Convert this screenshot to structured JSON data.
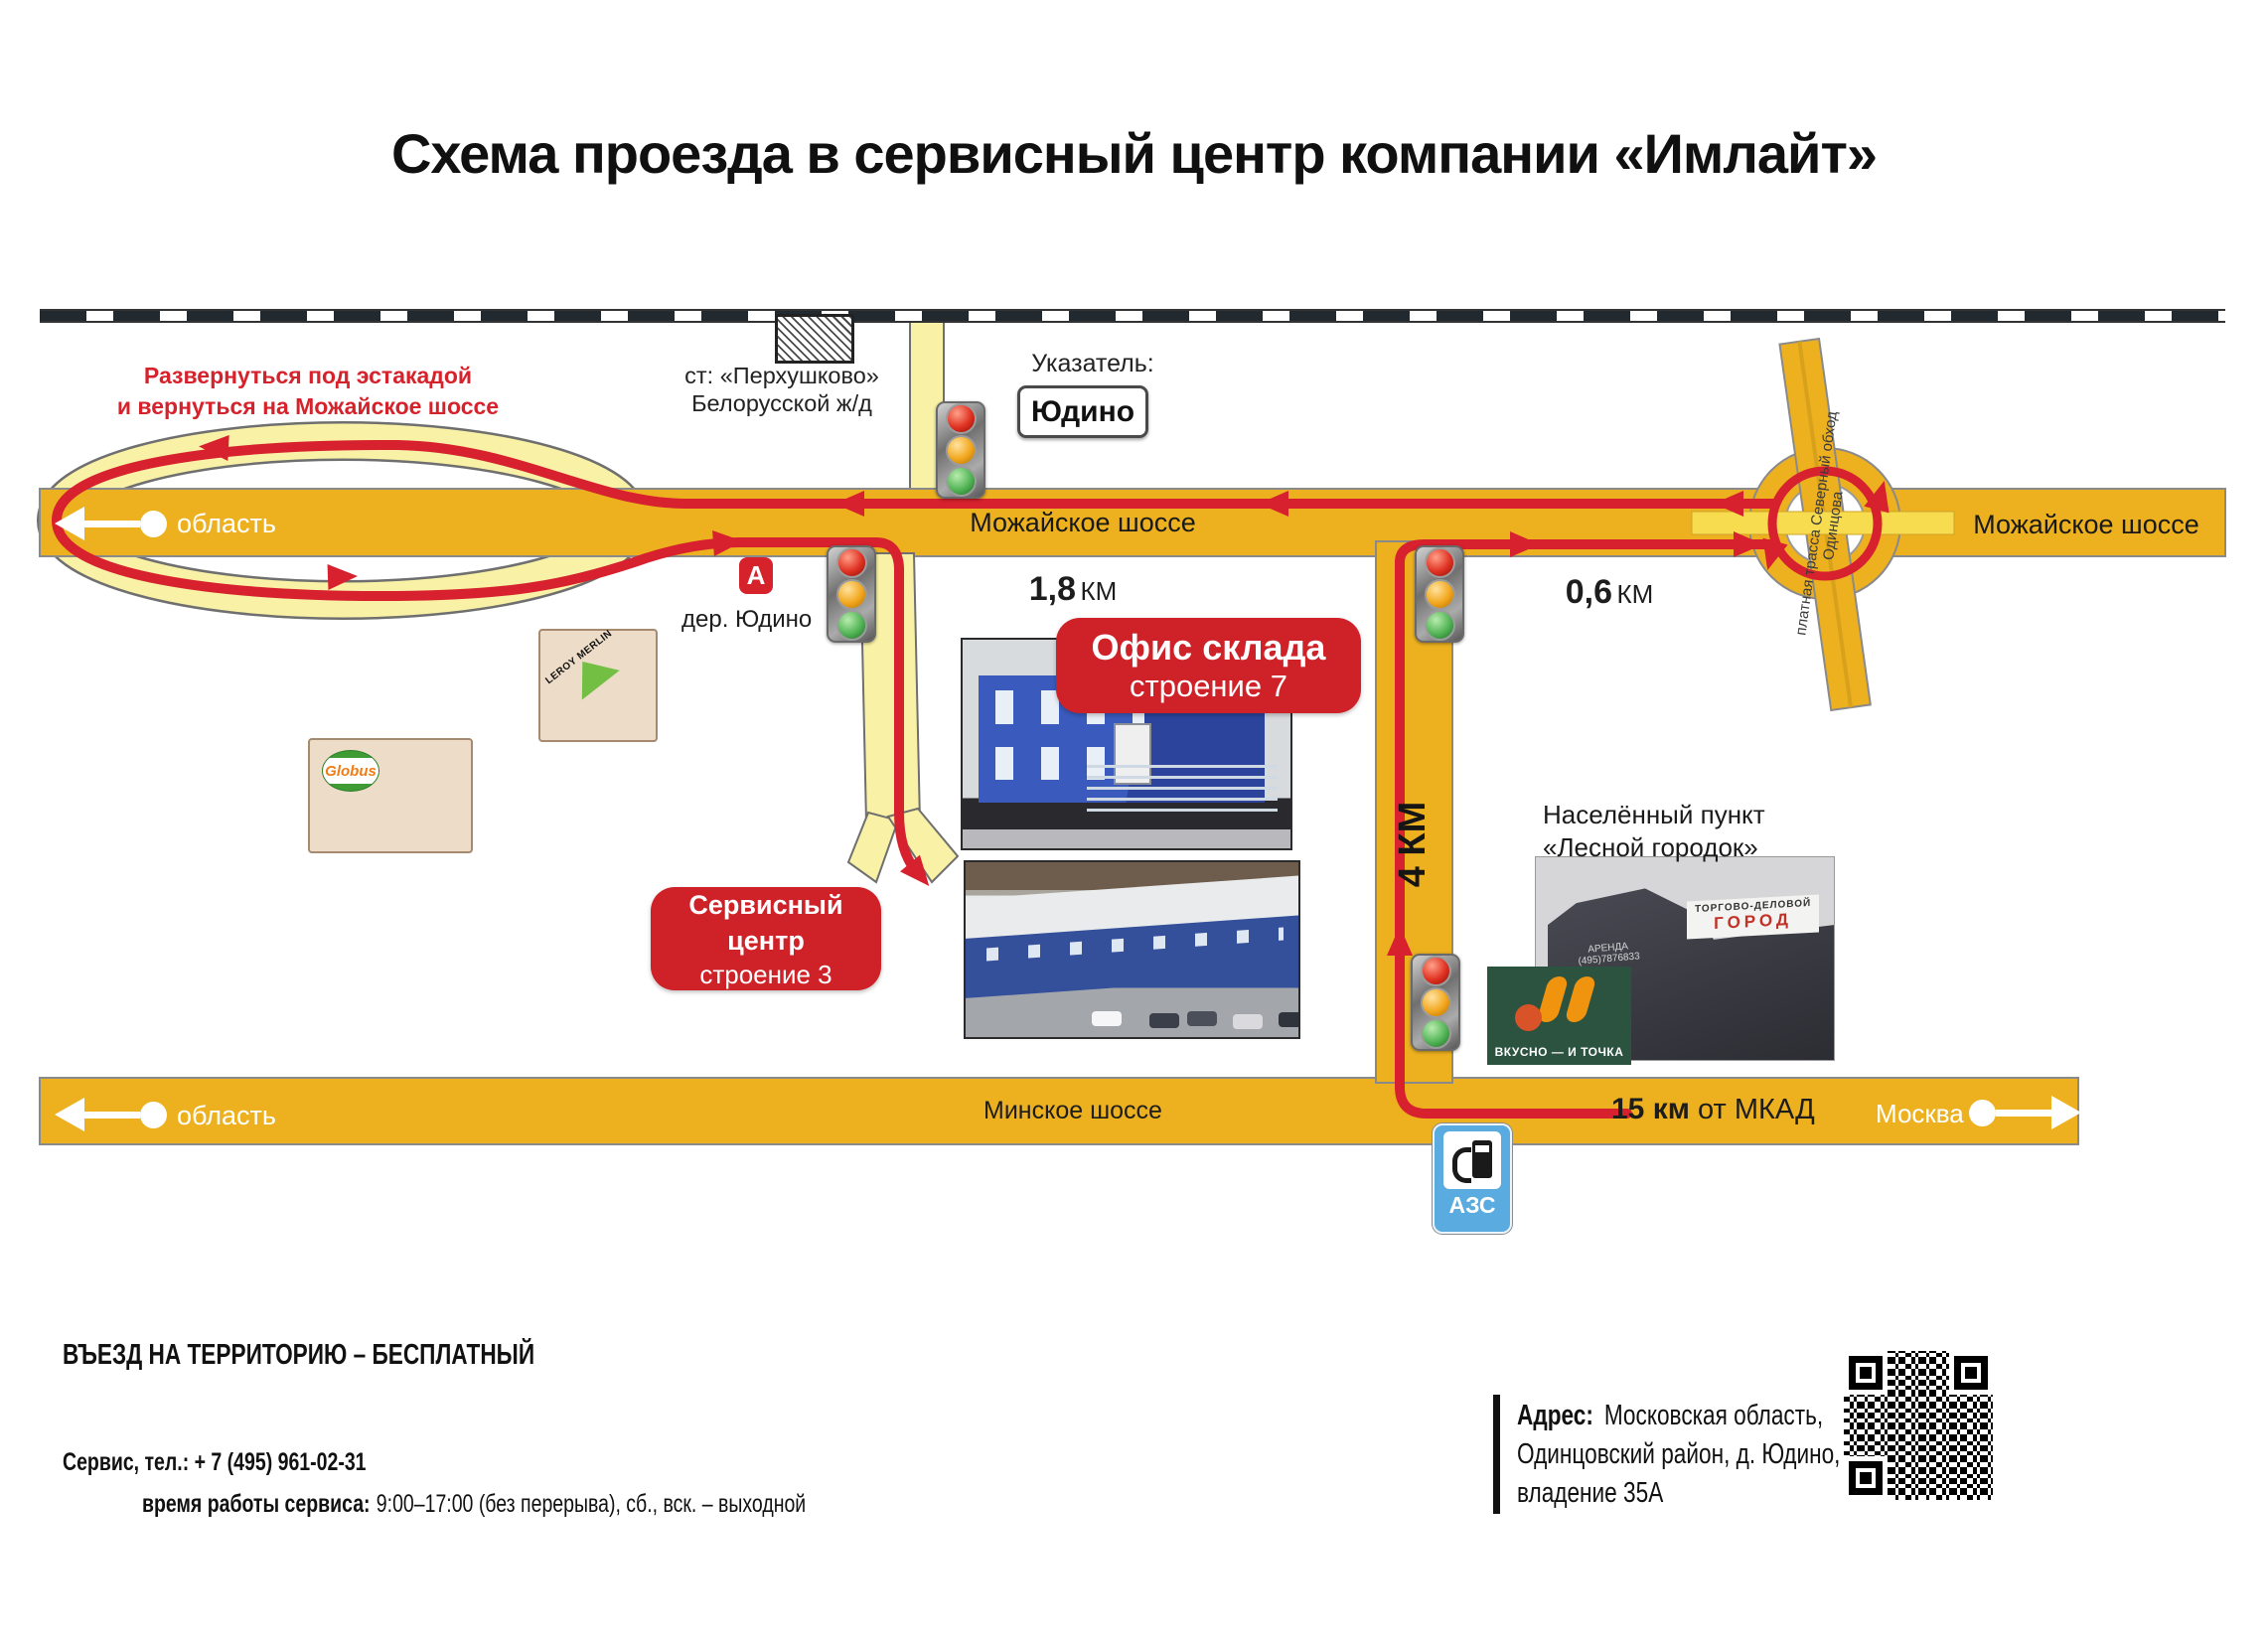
{
  "title": "Схема проезда в сервисный центр компании «Имлайт»",
  "colors": {
    "road_orange": "#edb11f",
    "pale_yellow_road": "#f9f2a6",
    "route_red": "#d7212e",
    "badge_red": "#cf2128",
    "note_text_red": "#d6222b",
    "azs_blue": "#5aabdf",
    "vkusno_green": "#2c5240",
    "leroy_green": "#72bf44",
    "globus_orange": "#ef7d17"
  },
  "notes": {
    "uturn_line1": "Развернуться под эстакадой",
    "uturn_line2": "и вернуться на Можайское шоссе"
  },
  "station": {
    "line1": "ст: «Перхушково»",
    "line2": "Белорусской ж/д"
  },
  "pointer": {
    "label": "Указатель:",
    "value": "Юдино"
  },
  "roads": {
    "mozhayskoe": "Можайское шоссе",
    "mozhayskoe_right": "Можайское шоссе",
    "minskoe": "Минское шоссе",
    "toll": "платная трасса Северный обход Одинцова"
  },
  "directions": {
    "oblast_top": "область",
    "oblast_bottom": "область",
    "moscow": "Москва"
  },
  "distances": {
    "d18": "1,8",
    "d18_unit": "КМ",
    "d06": "0,6",
    "d06_unit": "КМ",
    "d4": "4 КМ",
    "d15": "15 км",
    "d15_rest": "от МКАД"
  },
  "stops": {
    "bus_letter": "А",
    "village": "дер. Юдино"
  },
  "badges": {
    "office_line1": "Офис склада",
    "office_line2": "строение 7",
    "service_line1": "Сервисный центр",
    "service_line2": "строение 3"
  },
  "settlement": {
    "line1": "Населённый пункт",
    "line2": "«Лесной городок»"
  },
  "landmarks": {
    "leroy_line1": "LEROY",
    "leroy_line2": "MERLIN",
    "globus": "Globus",
    "vkusno": "ВКУСНО — И ТОЧКА",
    "gorod_line1": "ТОРГОВО-ДЕЛОВОЙ",
    "gorod_line2": "ГОРОД",
    "gorod_arenda": "АРЕНДА",
    "gorod_phone": "(495)7876833",
    "azs": "АЗС"
  },
  "footer": {
    "free_entry": "ВЪЕЗД НА ТЕРРИТОРИЮ – БЕСПЛАТНЫЙ",
    "phone_label": "Сервис, тел.:",
    "phone_value": "+ 7 (495) 961-02-31",
    "hours_label": "время работы сервиса:",
    "hours_value": "9:00–17:00 (без перерыва),  сб., вск. – выходной",
    "address_label": "Адрес:",
    "address_line1": "Московская область,",
    "address_line2": "Одинцовский район, д. Юдино,",
    "address_line3": "владение 35А"
  }
}
